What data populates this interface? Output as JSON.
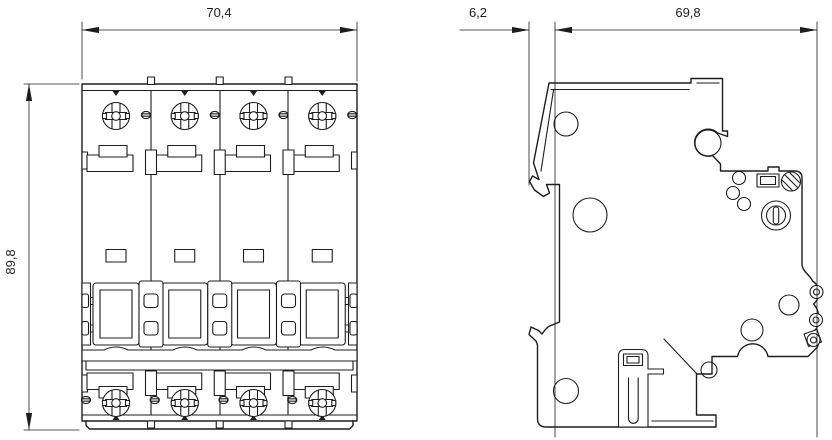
{
  "drawing": {
    "kind": "dimension-drawing",
    "subject": "4-pole miniature circuit breaker, front and side outline views"
  },
  "dimensions": {
    "front_width": "70,4",
    "front_height": "89,8",
    "side_handle_offset": "6,2",
    "side_depth": "69,8"
  },
  "colors": {
    "line": "#1d1d1d",
    "background": "#ffffff"
  }
}
